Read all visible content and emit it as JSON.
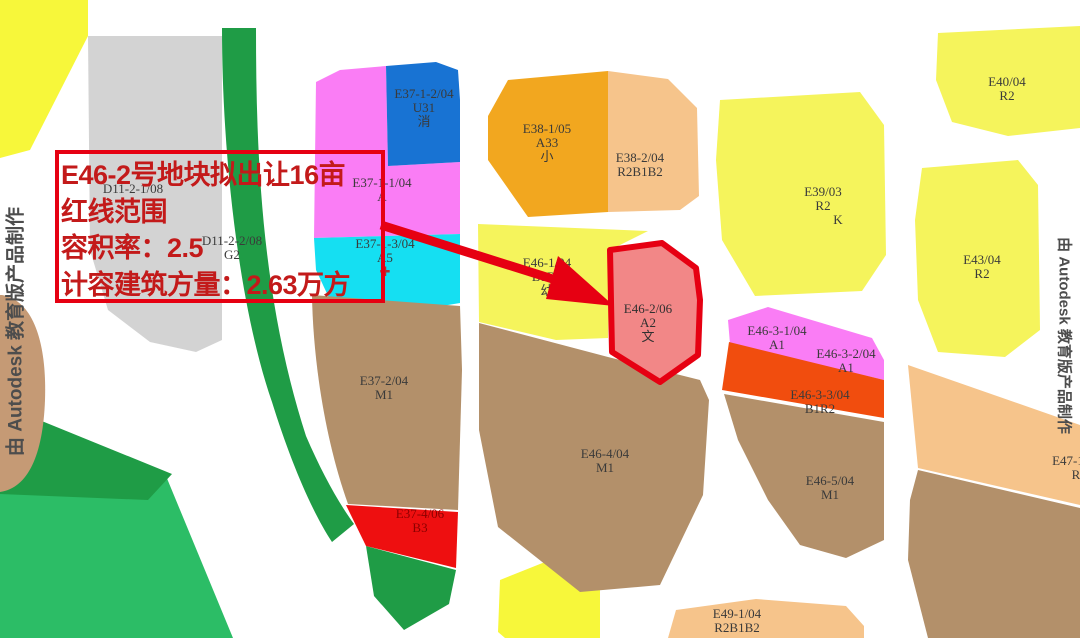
{
  "annotation": {
    "line1": "E46-2号地块拟出让16亩",
    "line2": "红线范围",
    "line3": "容积率：2.5",
    "line4": "计容建筑方量：2.63万方"
  },
  "watermark": {
    "text": "由 Autodesk 教育版产品制作"
  },
  "parcels": {
    "d11_2_1": {
      "code": "D11-2-1/08"
    },
    "d11_2_2": {
      "code": "D11-2-2/08",
      "use": "G2"
    },
    "e37_1_2": {
      "code": "E37-1-2/04",
      "use": "U31",
      "note": "消"
    },
    "e37_1_1": {
      "code": "E37-1-1/04",
      "use": "A"
    },
    "e37_1_3": {
      "code": "E37-1-3/04",
      "use": "A5",
      "note": "✚"
    },
    "e37_2": {
      "code": "E37-2/04",
      "use": "M1"
    },
    "e37_4": {
      "code": "E37-4/06",
      "use": "B3"
    },
    "e38_1": {
      "code": "E38-1/05",
      "use": "A33",
      "note": "小"
    },
    "e38_2": {
      "code": "E38-2/04",
      "use": "R2B1B2"
    },
    "e39": {
      "code": "E39/03",
      "use": "R2",
      "note": "K"
    },
    "e40": {
      "code": "E40/04",
      "use": "R2"
    },
    "e43": {
      "code": "E43/04",
      "use": "R2"
    },
    "e46_1": {
      "code": "E46-1/04",
      "use": "B1B2",
      "note": "幼"
    },
    "e46_2": {
      "code": "E46-2/06",
      "use": "A2",
      "note": "文"
    },
    "e46_3_1": {
      "code": "E46-3-1/04",
      "use": "A1"
    },
    "e46_3_2": {
      "code": "E46-3-2/04",
      "use": "A1"
    },
    "e46_3_3": {
      "code": "E46-3-3/04",
      "use": "B1R2"
    },
    "e46_4": {
      "code": "E46-4/04",
      "use": "M1"
    },
    "e46_5": {
      "code": "E46-5/04",
      "use": "M1"
    },
    "e47_1": {
      "code": "E47-1",
      "use": "R"
    },
    "e49_1": {
      "code": "E49-1/04",
      "use": "R2B1B2"
    }
  },
  "colors": {
    "annotation_red": "#e60012",
    "annotation_text": "#c31a1a",
    "parcel_yellow": "#f5f45c",
    "bright_yellow": "#f7f73a",
    "industrial_brown": "#b3906a",
    "tan_blob": "#c59a75",
    "green_dark": "#1f9c46",
    "green_light": "#2cbd66",
    "commercial_red": "#ee0f10",
    "admin_pink": "#fa7df5",
    "fire_blue": "#1873d3",
    "medical_cyan": "#15dff2",
    "school_orange": "#f2a71f",
    "mixed_peach": "#f6c48b",
    "orange_red": "#f14d0e",
    "target_salmon": "#f28787",
    "gray_parcel": "#d3d3d3",
    "road_white": "#ffffff",
    "label_text": "#3a3a3a"
  }
}
